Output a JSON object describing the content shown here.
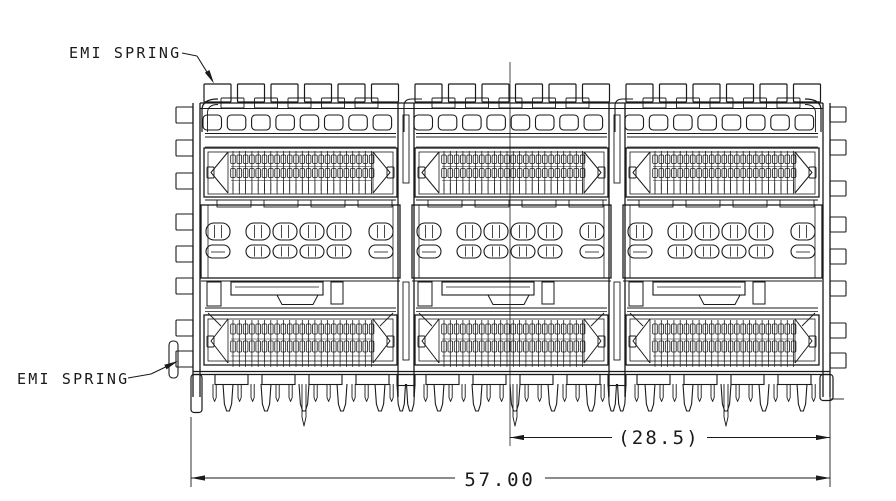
{
  "page": {
    "background": "#ffffff"
  },
  "labels": {
    "emi_spring_top": "EMI SPRING",
    "emi_spring_bottom": "EMI SPRING"
  },
  "dimensions": {
    "half_width": "(28.5)",
    "overall_width": "57.00"
  },
  "drawing": {
    "modules": 3,
    "emi_tabs_per_module": 6,
    "u_cutouts_per_module": 8,
    "contacts_per_module": 23,
    "louvers_per_row": 6,
    "big_pins_per_module": 5,
    "feet_per_module": 4,
    "line_color": "#1a1a1a"
  }
}
